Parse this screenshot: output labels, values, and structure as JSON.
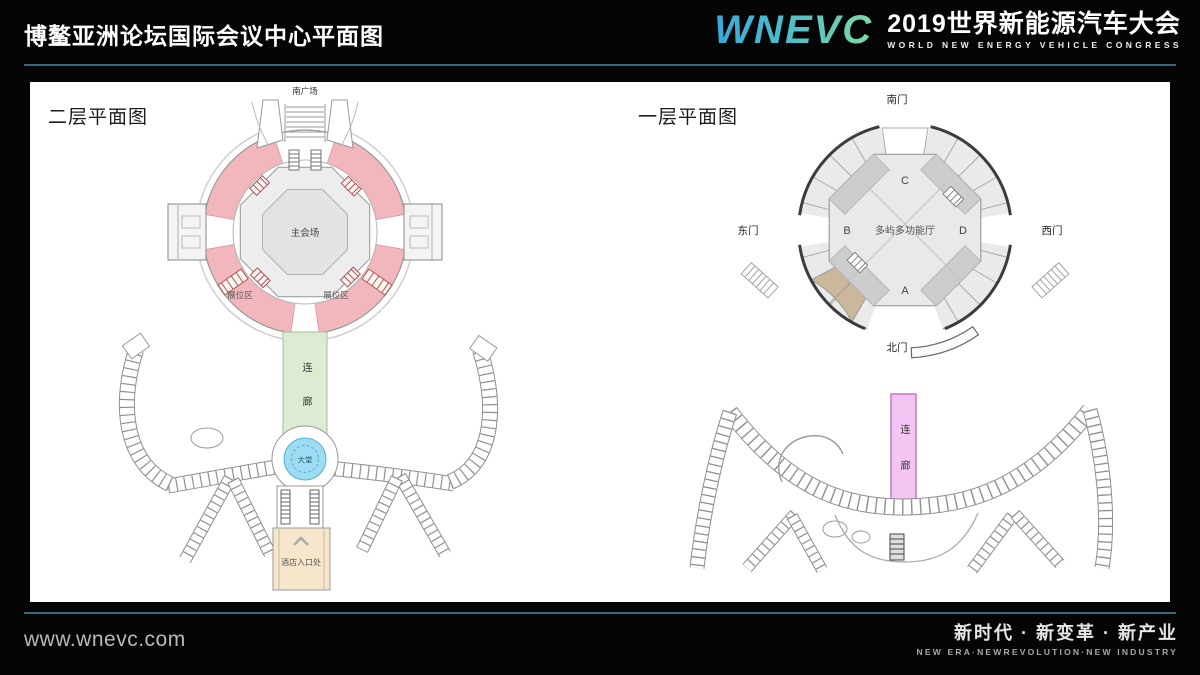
{
  "header": {
    "page_title": "博鳌亚洲论坛国际会议中心平面图",
    "logo": "WNEVC",
    "congress_cn": "2019世界新能源汽车大会",
    "congress_en": "WORLD NEW ENERGY VEHICLE CONGRESS"
  },
  "floor2": {
    "title": "二层平面图",
    "south_plaza": "南广场",
    "main_hall": "主会场",
    "booth_area": "展位区",
    "corridor": "连廊",
    "lobby": "大堂",
    "hotel_entrance": "酒店入口处"
  },
  "floor1": {
    "title": "一层平面图",
    "south_gate": "南门",
    "east_gate": "东门",
    "west_gate": "西门",
    "north_gate": "北门",
    "hall": "多屿多功能厅",
    "zone_a": "A",
    "zone_b": "B",
    "zone_c": "C",
    "zone_d": "D",
    "corridor": "连廊"
  },
  "footer": {
    "website": "www.wnevc.com",
    "slogan_cn": "新时代 · 新变革 · 新产业",
    "slogan_en": "NEW ERA·NEWREVOLUTION·NEW INDUSTRY"
  },
  "colors": {
    "accent_line": "#38697f",
    "booth_pink": "#f2b6bd",
    "corridor_green": "#dcebd2",
    "lobby_blue": "#9ddcf3",
    "entrance_tan": "#f6e7cc",
    "corridor_magenta": "#f4c4f3",
    "ring_tan": "#cbb89c"
  }
}
